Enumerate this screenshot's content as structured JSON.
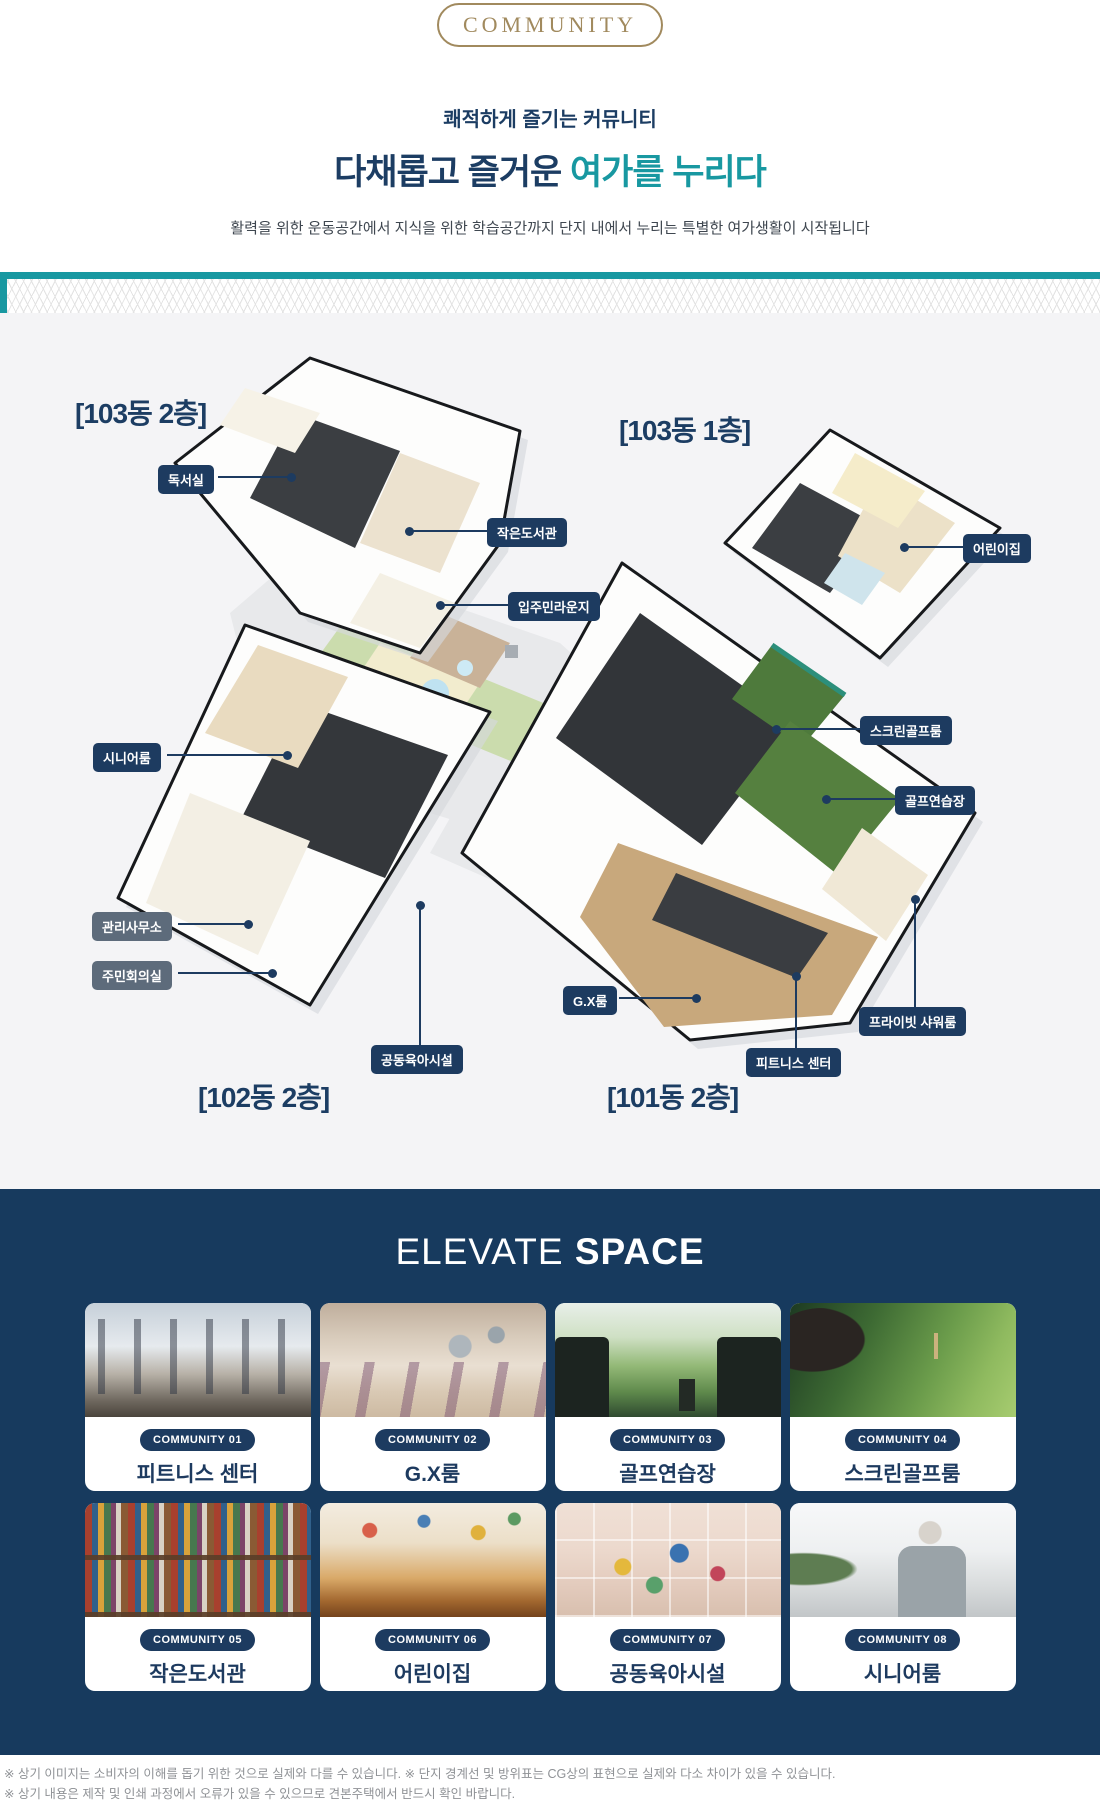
{
  "hero": {
    "badge": "COMMUNITY",
    "eyebrow": "쾌적하게 즐기는 커뮤니티",
    "title_prefix": "다채롭고 즐거운 ",
    "title_highlight": "여가를 누리다",
    "description": "활력을 위한 운동공간에서 지식을 위한 학습공간까지 단지 내에서 누리는 특별한 여가생활이 시작됩니다"
  },
  "colors": {
    "teal": "#1898a1",
    "navy": "#173a5e",
    "gold": "#a18a5e",
    "badge_navy": "#1d3b60",
    "badge_gray": "#5d6b7b"
  },
  "floor_plan": {
    "building_labels": [
      {
        "text": "[103동 2층]"
      },
      {
        "text": "[103동 1층]"
      },
      {
        "text": "[102동 2층]"
      },
      {
        "text": "[101동 2층]"
      }
    ],
    "room_labels": [
      {
        "text": "독서실"
      },
      {
        "text": "작은도서관"
      },
      {
        "text": "입주민라운지"
      },
      {
        "text": "어린이집"
      },
      {
        "text": "시니어룸"
      },
      {
        "text": "관리사무소"
      },
      {
        "text": "주민회의실"
      },
      {
        "text": "스크린골프룸"
      },
      {
        "text": "골프연습장"
      },
      {
        "text": "G.X룸"
      },
      {
        "text": "피트니스 센터"
      },
      {
        "text": "프라이빗 샤워룸"
      },
      {
        "text": "공동육아시설"
      }
    ]
  },
  "elevate": {
    "title_light": "ELEVATE",
    "title_bold": "SPACE",
    "cards": [
      {
        "tag": "COMMUNITY 01",
        "name": "피트니스 센터"
      },
      {
        "tag": "COMMUNITY 02",
        "name": "G.X룸"
      },
      {
        "tag": "COMMUNITY 03",
        "name": "골프연습장"
      },
      {
        "tag": "COMMUNITY 04",
        "name": "스크린골프룸"
      },
      {
        "tag": "COMMUNITY 05",
        "name": "작은도서관"
      },
      {
        "tag": "COMMUNITY 06",
        "name": "어린이집"
      },
      {
        "tag": "COMMUNITY 07",
        "name": "공동육아시설"
      },
      {
        "tag": "COMMUNITY 08",
        "name": "시니어룸"
      }
    ]
  },
  "footer": {
    "line1": "※ 상기 이미지는 소비자의 이해를 돕기 위한 것으로 실제와 다를 수 있습니다. ※ 단지 경계선 및 방위표는 CG상의 표현으로 실제와 다소 차이가 있을 수 있습니다.",
    "line2": "※ 상기 내용은 제작 및 인쇄 과정에서 오류가 있을 수 있으므로 견본주택에서 반드시 확인 바랍니다."
  }
}
